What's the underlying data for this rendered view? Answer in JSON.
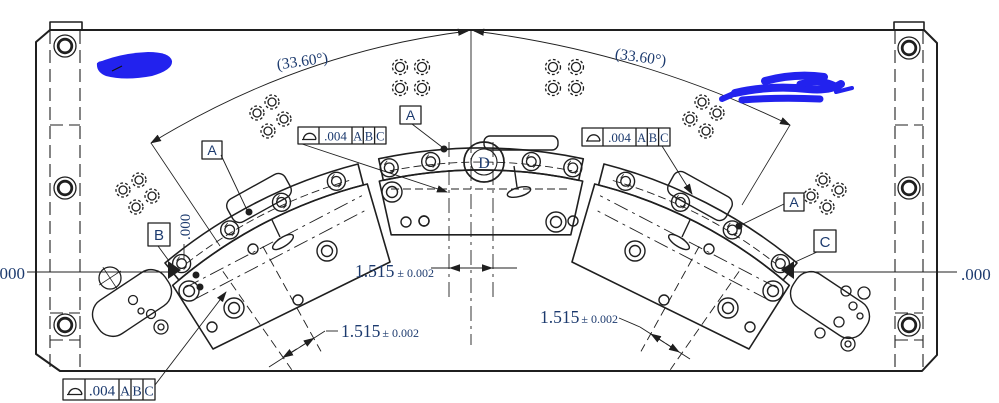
{
  "annotations": {
    "angle_left": "(33.60°)",
    "angle_right": "(33.60°)",
    "zero_left": ".000",
    "zero_right": ".000",
    "zero_vertical": ".000"
  },
  "dimensions": {
    "center": {
      "value": "1.515",
      "tolerance": "± 0.002"
    },
    "left": {
      "value": "1.515",
      "tolerance": "± 0.002"
    },
    "right": {
      "value": "1.515",
      "tolerance": "± 0.002"
    }
  },
  "gdt_frames": [
    {
      "symbol": "profile-of-a-surface",
      "tolerance": ".004",
      "datums": [
        "A",
        "B",
        "C"
      ]
    },
    {
      "symbol": "profile-of-a-surface",
      "tolerance": ".004",
      "datums": [
        "A",
        "B",
        "C"
      ]
    },
    {
      "symbol": "profile-of-a-surface",
      "tolerance": ".004",
      "datums": [
        "A",
        "B",
        "C"
      ]
    }
  ],
  "datum_labels": {
    "a": "A",
    "b": "B",
    "c": "C",
    "d": "D"
  },
  "colors": {
    "line": "#1f1f1f",
    "annotation": "#1c3a6e",
    "scribble": "#2222ee",
    "background": "#ffffff"
  }
}
